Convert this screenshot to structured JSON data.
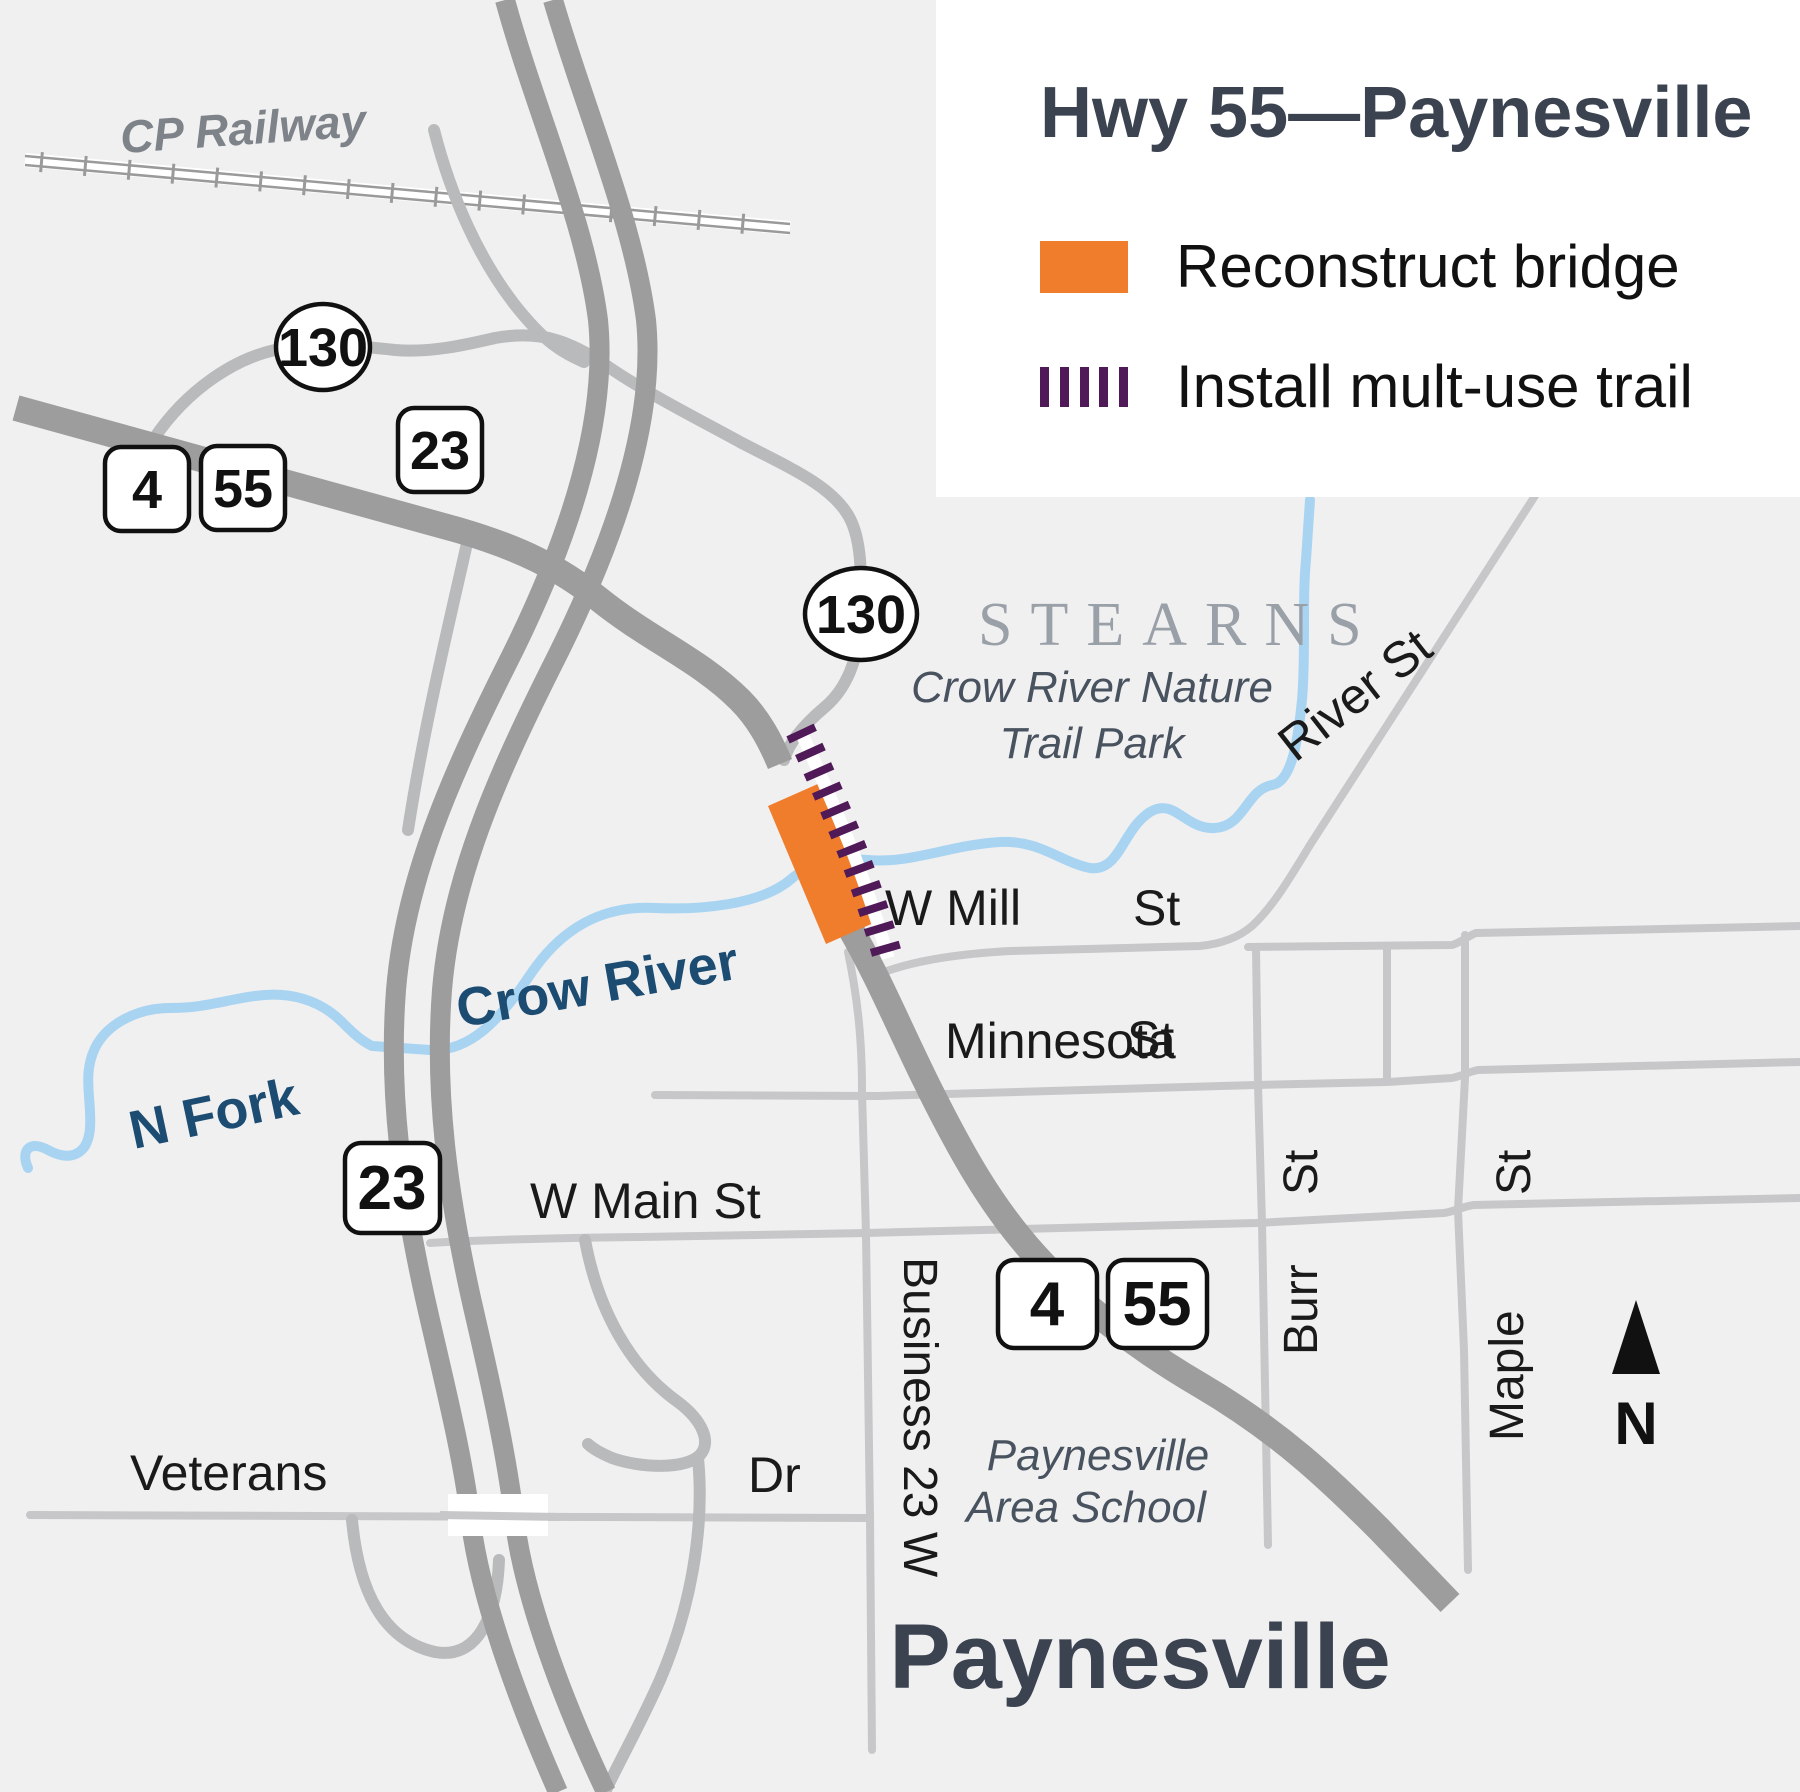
{
  "legend": {
    "title": "Hwy 55—Paynesville",
    "items": [
      {
        "label": "Reconstruct bridge",
        "swatch": "orange-rectangle",
        "color": "#f07d2b"
      },
      {
        "label": "Install mult-use trail",
        "swatch": "purple-dashes",
        "color": "#4f1a57"
      }
    ]
  },
  "map": {
    "county_label": "STEARNS",
    "city_label": "Paynesville",
    "railway_label": "CP Railway",
    "north_label": "N",
    "water": {
      "river": "Crow River",
      "fork": "N Fork"
    },
    "park": {
      "line1": "Crow River Nature",
      "line2": "Trail Park"
    },
    "school": {
      "line1": "Paynesville",
      "line2": "Area School"
    },
    "route_markers": {
      "oval_130_nw": "130",
      "oval_130_center": "130",
      "square_4_nw": "4",
      "square_55_nw": "55",
      "square_23_north": "23",
      "square_23_west": "23",
      "square_4_south": "4",
      "square_55_south": "55"
    },
    "streets": {
      "w_mill": "W Mill",
      "w_mill_st": "St",
      "minnesota": "Minnesota",
      "minnesota_st": "St",
      "w_main": "W Main St",
      "burr": "Burr",
      "burr_st": "St",
      "maple": "Maple",
      "maple_st": "St",
      "business_23": "Business 23 W",
      "veterans": "Veterans",
      "veterans_dr": "Dr",
      "river_st": "River St"
    },
    "colors": {
      "background": "#f0f0f1",
      "road_major": "#9d9d9d",
      "road_minor": "#c7c7c9",
      "river": "#a9d4f1",
      "bridge_orange": "#f07d2b",
      "trail_purple": "#4f1a57",
      "title_text": "#3b4250"
    }
  }
}
